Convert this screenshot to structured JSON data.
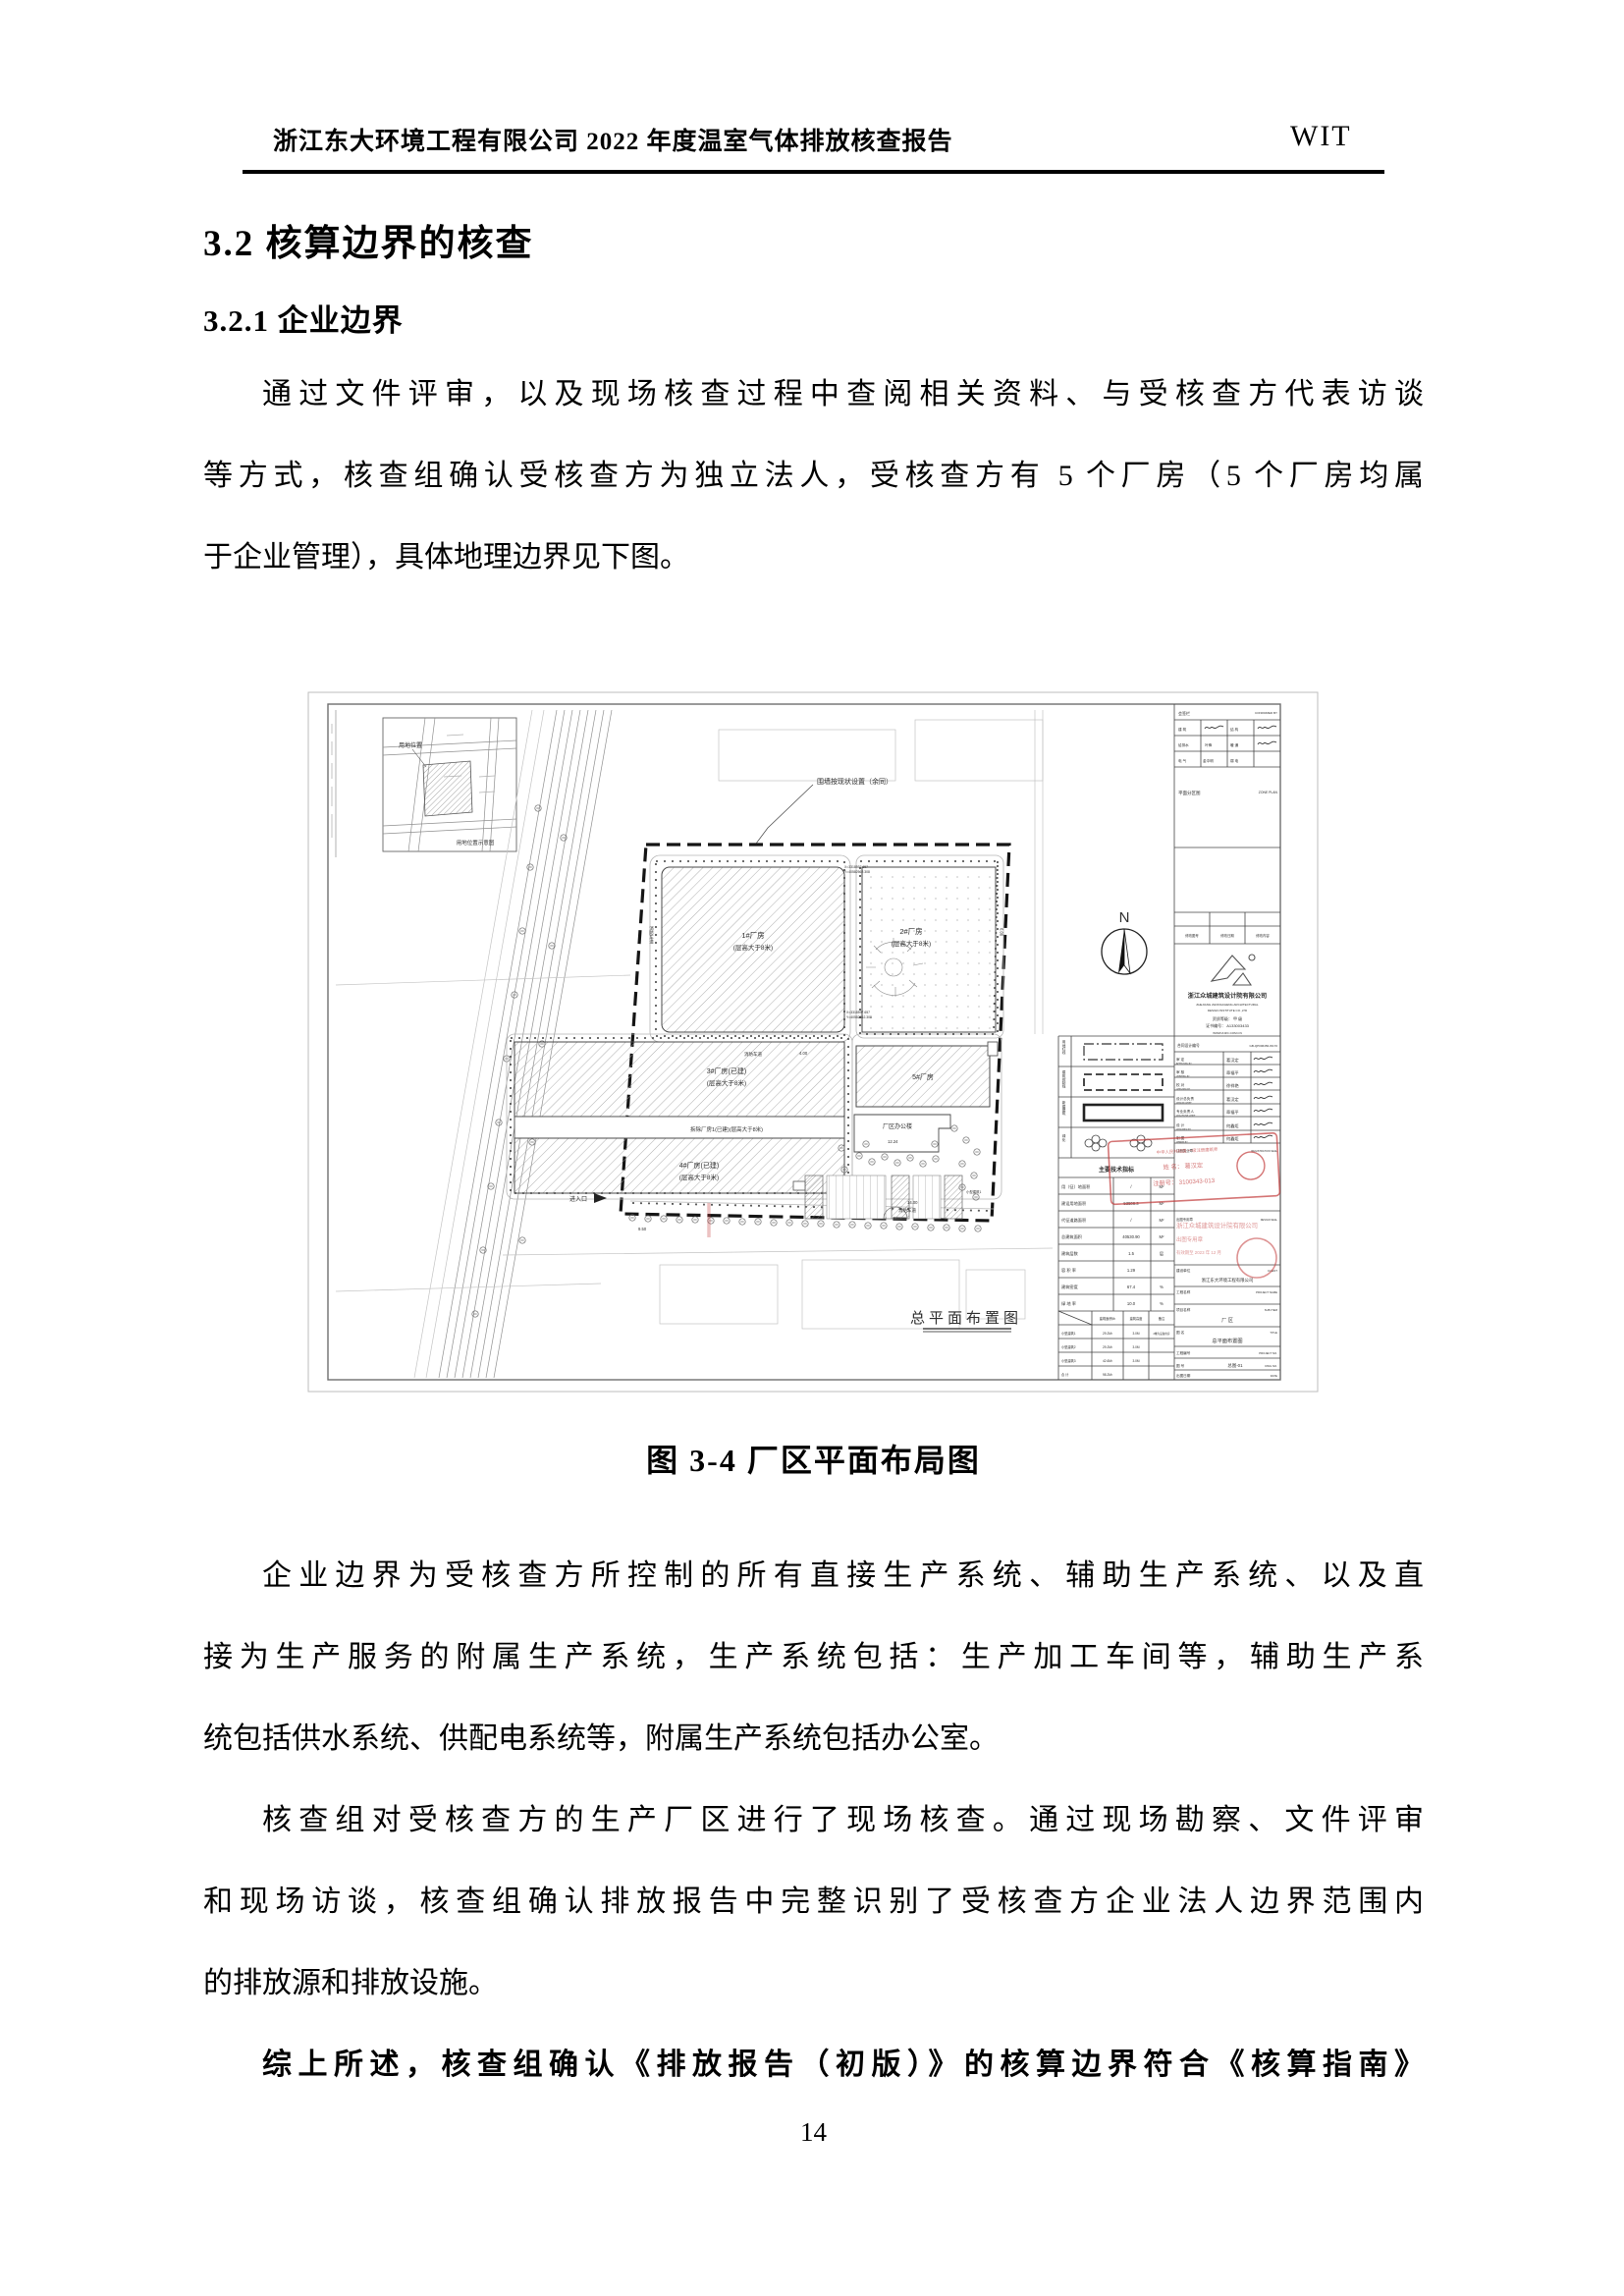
{
  "header": {
    "left": "浙江东大环境工程有限公司 2022 年度温室气体排放核查报告",
    "right": "WIT"
  },
  "headings": {
    "section": "3.2 核算边界的核查",
    "subsection": "3.2.1 企业边界"
  },
  "paragraphs": {
    "p1_lines": [
      "通过文件评审，以及现场核查过程中查阅相关资料、与受核查方代表访谈",
      "等方式，核查组确认受核查方为独立法人，受核查方有 5 个厂房（5 个厂房均属",
      "于企业管理），具体地理边界见下图。"
    ],
    "p2_lines": [
      "企业边界为受核查方所控制的所有直接生产系统、辅助生产系统、以及直",
      "接为生产服务的附属生产系统，生产系统包括：生产加工车间等，辅助生产系",
      "统包括供水系统、供配电系统等，附属生产系统包括办公室。"
    ],
    "p3_lines": [
      "核查组对受核查方的生产厂区进行了现场核查。通过现场勘察、文件评审",
      "和现场访谈，核查组确认排放报告中完整识别了受核查方企业法人边界范围内",
      "的排放源和排放设施。"
    ],
    "p4_line": "综上所述，核查组确认《排放报告（初版）》的核算边界符合《核算指南》"
  },
  "figure": {
    "caption": "图 3-4  厂区平面布局图"
  },
  "page_number": "14",
  "drawing": {
    "inset": {
      "label": "用地位置",
      "caption": "用地位置示意图"
    },
    "wall_note": "围墙按现状设置（余同）",
    "north": "N",
    "b1_l1": "1#厂房",
    "b1_l2": "(层高大于8米)",
    "b2_l1": "2#厂房",
    "b2_l2": "(层高大于8米)",
    "b3_l1": "3#厂房(已建)",
    "b3_l2": "(层高大于8米)",
    "strip": "拆除厂房1(已建)(层高大于8米)",
    "b4_l1": "4#厂房(已建)",
    "b4_l2": "(层高大于8米)",
    "b5": "5#厂房",
    "office": "厂区办公楼",
    "entrance": "进入口",
    "fire_lane": "消防车道",
    "small_bldg": "小型建筑1",
    "coord_x": "X=3318597.657",
    "coord_y": "Y=40582562.308",
    "dim1": "6.00",
    "dim2": "4.00",
    "dim3": "12.24",
    "dim4": "14.00",
    "dim5": "9.50",
    "plan_title": "总平面布置图",
    "legend": {
      "v1": "用地红线",
      "v2": "建筑控制线",
      "v3": "新建建筑",
      "v4": "绿化"
    },
    "sign": {
      "title": "会签栏",
      "title_en": "CONFIRMED BY",
      "r1a": "建 筑",
      "r1b": "结 构",
      "r2a": "给排水",
      "r2b": "暖 通",
      "r3a": "电 气",
      "r3b": "弱 电",
      "n1": "叶锋",
      "n2": "金中明"
    },
    "zone": "平面分区图",
    "zone_en": "ZONE PLAN",
    "rev": {
      "c1": "修改图号",
      "c2": "修改日期",
      "c3": "修改内容"
    },
    "company": {
      "cn": "浙江众城建筑设计院有限公司",
      "en1": "ZHEJIANG ZHONGCHENG ARCHITECTURAL",
      "en2": "DESIGN INSTITUTE CO.,LTD",
      "cert": "资质等级： 甲 级",
      "cert_no": "证书编号： A133003433",
      "web": "WWW.ZJZC.COM.CN"
    },
    "contract": {
      "label": "合同设计编号",
      "value": "GB-QP006456-W170"
    },
    "sig_rows": [
      {
        "cn": "审 定",
        "en": "APPROVED BY",
        "name": "葛汉定"
      },
      {
        "cn": "审 核",
        "en": "VERIFIED BY",
        "name": "章福平"
      },
      {
        "cn": "校 对",
        "en": "CHECKED BY",
        "name": "徐祥艳"
      },
      {
        "cn": "设计总负责",
        "en": "DESIGN CHIEF",
        "name": "葛汉定"
      },
      {
        "cn": "专业负责人",
        "en": "DISCIPLINE CHIEF",
        "name": "章福平"
      },
      {
        "cn": "设 计",
        "en": "DESIGNED BY",
        "name": "何鑫炬"
      },
      {
        "cn": "制 图",
        "en": "DRAWN BY",
        "name": "何鑫炬"
      }
    ],
    "seal1": {
      "label": "注册执业章",
      "en": "REGISTRATION SEAL",
      "t1": "中华人民共和国 一级注册建筑师",
      "t2": "姓 名： 葛汉定",
      "t3": "注册号： 3100343-013"
    },
    "seal2": {
      "label": "出图专用章",
      "en": "DESIGN SEAL",
      "t1": "浙江众城建筑设计院有限公司",
      "t2": "出图专用章",
      "t3": "有效期至 2023 年 12 月"
    },
    "info": {
      "client": "建设单位",
      "client_en": "CLIENT",
      "client_val": "浙江东大环境工程有限公司",
      "project": "工程名称",
      "project_en": "PROJECT NAME",
      "sub": "项目名称",
      "sub_en": "SUB ITEM",
      "sub_val": "厂 区",
      "title": "图 名",
      "title_en": "TITLE",
      "title_val": "总平面布置图",
      "pno": "工程编号",
      "pno_en": "PROJECT NO.",
      "dno": "图 号",
      "dno_en": "DWG NO.",
      "dno_val": "总图-01",
      "date": "出图日期",
      "date_en": "DATE"
    },
    "tech": {
      "header": "主要技术指标",
      "rows": [
        {
          "label": "用（征）地面积",
          "value": "/",
          "unit": "M²"
        },
        {
          "label": "建设用地面积",
          "value": "53506.3",
          "unit": "M²"
        },
        {
          "label": "代征道路面积",
          "value": "/",
          "unit": "M²"
        },
        {
          "label": "总建筑面积",
          "value": "40530.90",
          "unit": "M²"
        },
        {
          "label": "建筑层数",
          "value": "1.5",
          "unit": "层"
        },
        {
          "label": "容 积 率",
          "value": "1.29",
          "unit": ""
        },
        {
          "label": "建筑密度",
          "value": "67.4",
          "unit": "%"
        },
        {
          "label": "绿 地 率",
          "value": "10.0",
          "unit": "%"
        }
      ],
      "small_header": [
        "建筑面积M²",
        "建筑高度",
        "备注"
      ],
      "small_rows": [
        {
          "label": "小型建筑1",
          "area": "29.2M²",
          "height": "3.0M",
          "note": "2幢为设备用房"
        },
        {
          "label": "小型建筑2",
          "area": "29.2M²",
          "height": "3.0M",
          "note": ""
        },
        {
          "label": "小型建筑3",
          "area": "42.6M²",
          "height": "3.0M",
          "note": ""
        },
        {
          "label": "合 计",
          "area": "98.2M²",
          "height": "",
          "note": ""
        }
      ]
    }
  }
}
